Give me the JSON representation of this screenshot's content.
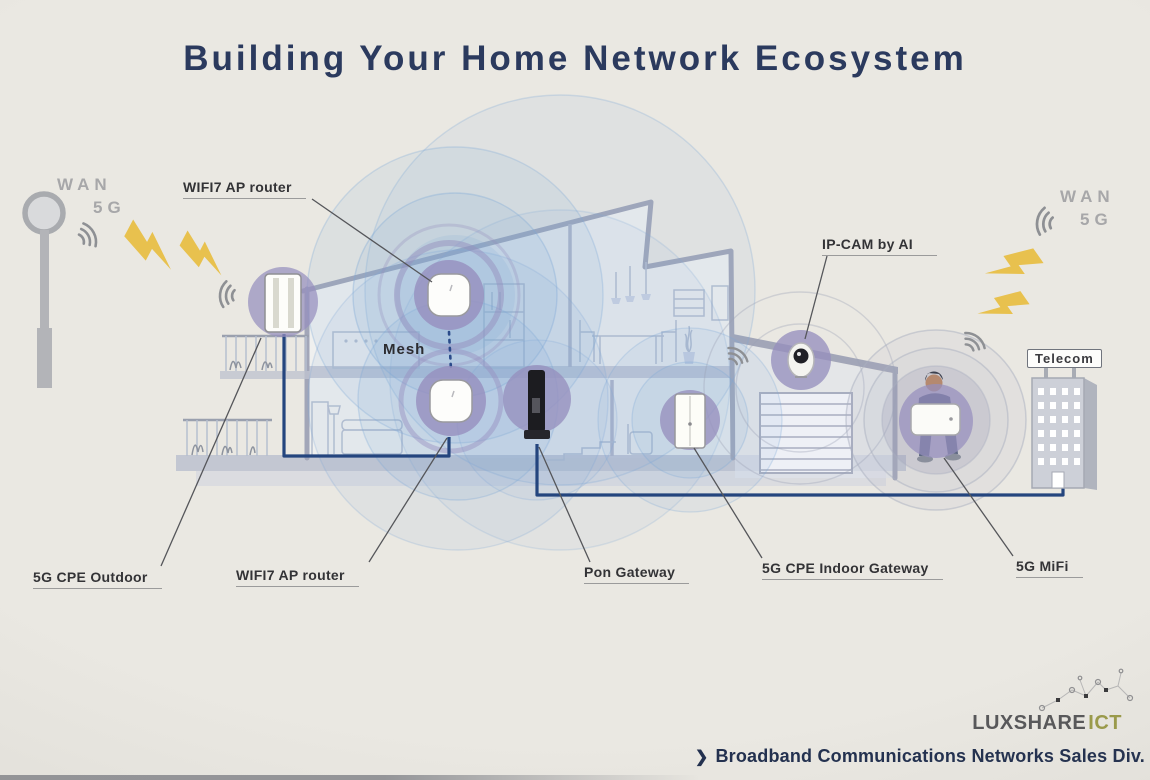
{
  "title": "Building Your Home Network Ecosystem",
  "wan_left": {
    "line1": "WAN",
    "line2": "5G"
  },
  "wan_right": {
    "line1": "WAN",
    "line2": "5G"
  },
  "callouts": {
    "wifi7_ap_top": "WIFI7 AP router",
    "wifi7_ap_bottom": "WIFI7 AP router",
    "cpe_outdoor": "5G CPE Outdoor",
    "pon_gateway": "Pon Gateway",
    "cpe_indoor_gateway": "5G CPE Indoor Gateway",
    "mifi": "5G MiFi",
    "ip_cam": "IP-CAM by AI",
    "mesh": "Mesh",
    "telecom": "Telecom"
  },
  "footer": {
    "brand_primary": "LUXSHARE",
    "brand_secondary": "ICT",
    "chevron": "❯",
    "division": "Broadband Communications Networks Sales Div."
  },
  "colors": {
    "title_text": "#2b3a5e",
    "label_text": "#333336",
    "wan_text": "#a7a7a9",
    "cable": "#24457e",
    "lightning": "#e8c14e",
    "halo": "#968fbe",
    "coverage": "#7ea9d6",
    "house_line": "#a2a6b8",
    "brand_gray": "#58585a",
    "brand_olive": "#9b9b4a",
    "footer_navy": "#22304f",
    "bg": "#eae8e2"
  }
}
